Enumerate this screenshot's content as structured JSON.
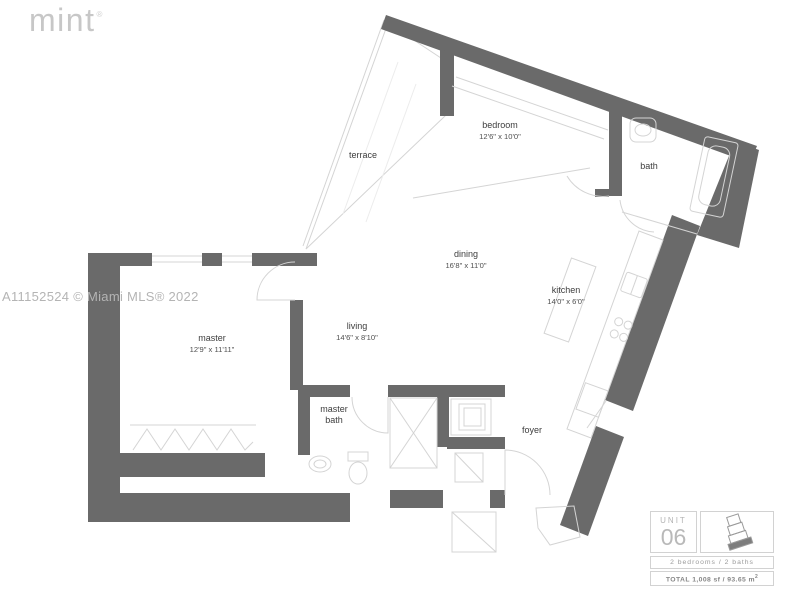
{
  "logo": {
    "text": "mint",
    "mark": "®"
  },
  "watermark": "A11152524 © Miami MLS® 2022",
  "rooms": {
    "terrace": {
      "label": "terrace"
    },
    "bedroom": {
      "label": "bedroom",
      "dims": "12'6\" x 10'0\""
    },
    "bath": {
      "label": "bath"
    },
    "dining": {
      "label": "dining",
      "dims": "16'8\" x 11'0\""
    },
    "kitchen": {
      "label": "kitchen",
      "dims": "14'0\" x 6'0\""
    },
    "master": {
      "label": "master",
      "dims": "12'9\" x 11'11\""
    },
    "living": {
      "label": "living",
      "dims": "14'6\" x 8'10\""
    },
    "master_bath": {
      "line1": "master",
      "line2": "bath"
    },
    "foyer": {
      "label": "foyer"
    }
  },
  "unit_info": {
    "unit_label": "UNIT",
    "unit_number": "06",
    "beds_baths": "2 bedrooms / 2 baths",
    "total_label": "TOTAL",
    "total_value": "1,008 sf / 93.65 m",
    "total_sup": "2"
  },
  "colors": {
    "wall": "#6a6a6a",
    "thin_line": "#d4d4d4",
    "label_text": "#3d3d3d",
    "logo": "#c7c7c7",
    "watermark": "#b4b4b4",
    "panel_border": "#d2d2d2",
    "panel_text": "#9a9a9a"
  }
}
